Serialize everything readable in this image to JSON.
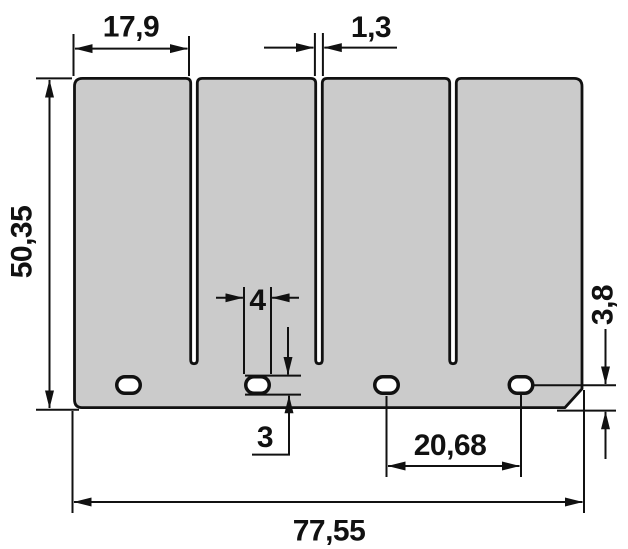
{
  "drawing": {
    "plate": {
      "fill": "#cbcbcb",
      "stroke": "#111111"
    },
    "dim_labels": {
      "finger_width": "17,9",
      "slot_width": "1,3",
      "plate_height": "50,35",
      "hole_width": "4",
      "hole_height": "3",
      "hole_pitch": "20,68",
      "hole_edge_offset": "3,8",
      "plate_width": "77,55"
    }
  }
}
